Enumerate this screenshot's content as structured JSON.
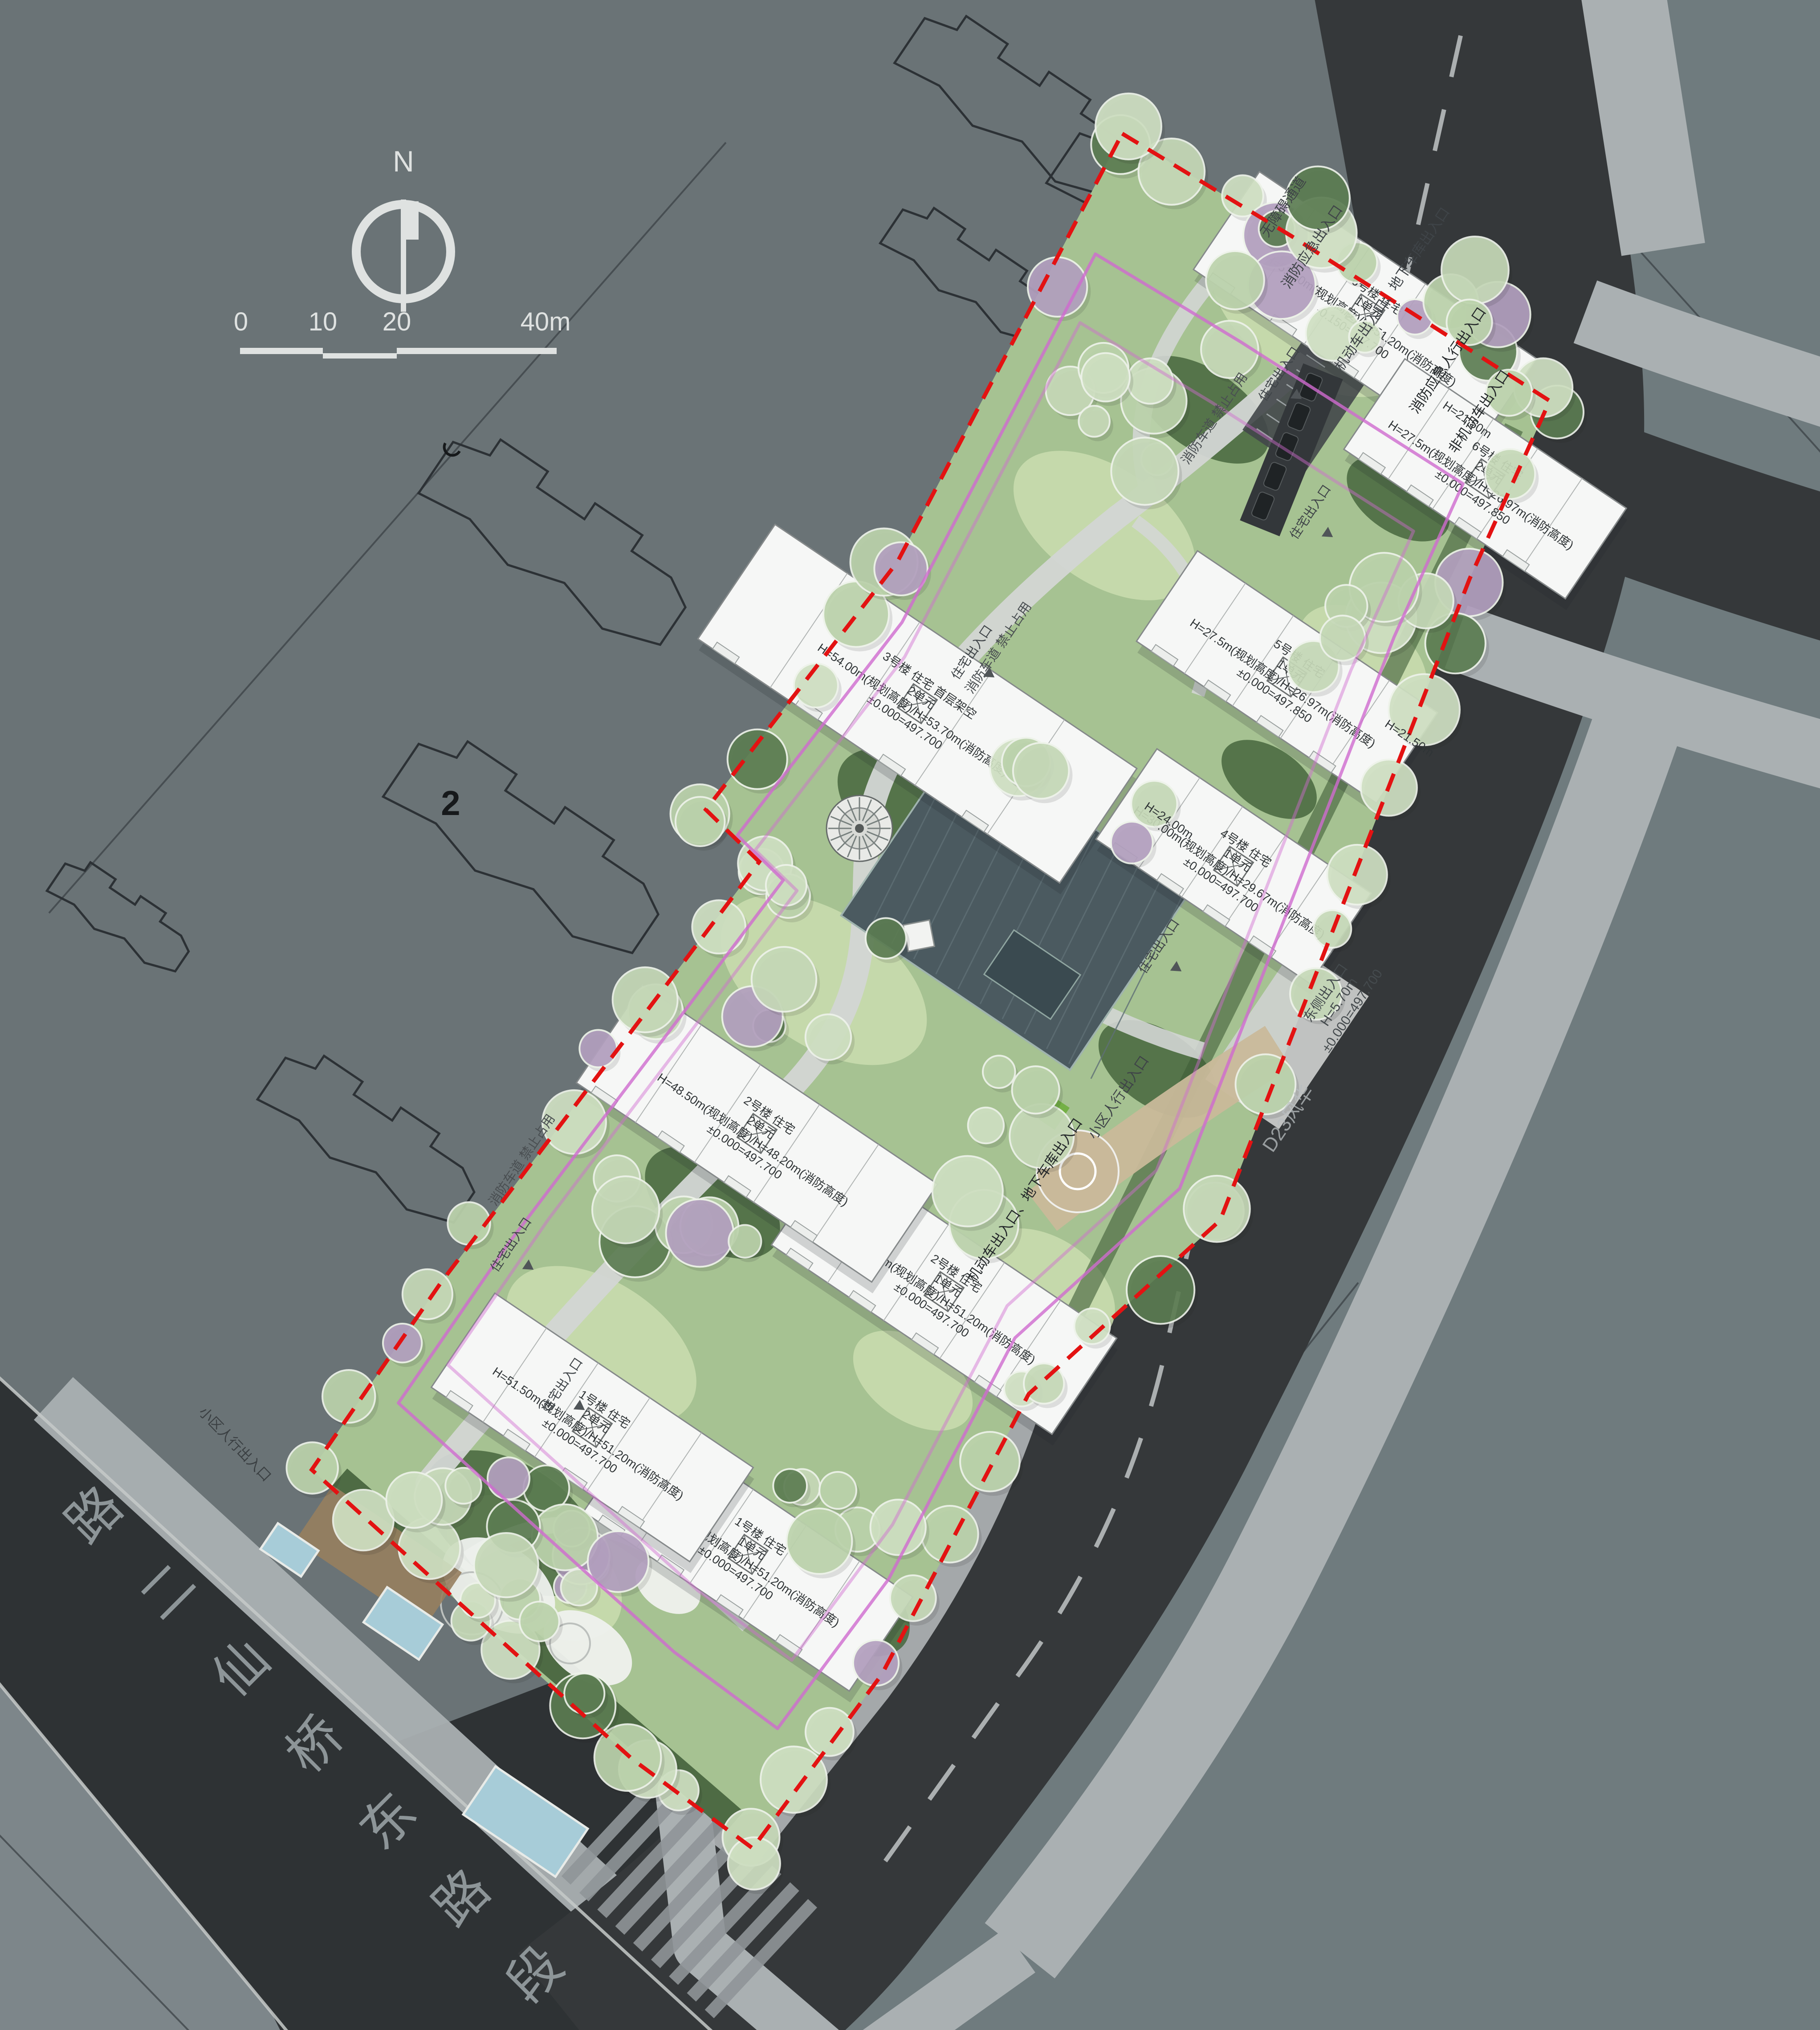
{
  "page": {
    "type": "architectural-site-plan"
  },
  "compass": {
    "label": "N"
  },
  "scale_bar": {
    "ticks": [
      "0",
      "10",
      "20",
      "40m"
    ]
  },
  "context": {
    "parcel_label": "2",
    "road_name_chars": [
      "路",
      "二",
      "仙",
      "桥",
      "东",
      "路",
      "段"
    ]
  },
  "labels": {
    "residential_entrance": "住宅出入口",
    "community_pedestrian_entrance": "小区人行出入口",
    "motor_entrance": "机动车出入口、地下车库出入口",
    "non_motor_entrance": "非机动车出入口",
    "fire_emergency_pedestrian_entrance": "消防应急人行出入口",
    "fire_emergency_entrance": "消防应急出入口",
    "barrier_free_passage": "无障碍通道",
    "fire_lane": "消防车道 禁止占用",
    "road_watermark": "D23风华",
    "h24": "H=24.00m",
    "h215": "H=21.50m",
    "east_entrance": {
      "line1": "东侧出入口",
      "line2": "H=5.70m",
      "line3": "±0.000=497.700"
    }
  },
  "buildings": [
    {
      "name": "1号楼 住宅",
      "unit": "1单元",
      "height": "H=51.50m(规划高度)/H=51.20m(消防高度)",
      "level": "±0.000=497.700"
    },
    {
      "name": "1号楼 住宅",
      "unit": "2单元",
      "height": "H=51.50m(规划高度)/H=51.20m(消防高度)",
      "level": "±0.000=497.700"
    },
    {
      "name": "2号楼 住宅",
      "unit": "1单元",
      "height": "H=51.50m(规划高度)/H=51.20m(消防高度)",
      "level": "±0.000=497.700"
    },
    {
      "name": "2号楼 住宅",
      "unit": "2单元",
      "height": "H=48.50m(规划高度)/H=48.20m(消防高度)",
      "level": "±0.000=497.700"
    },
    {
      "name": "3号楼 住宅 首层架空",
      "unit": "2单元",
      "height": "H=54.00m(规划高度)/H=53.70m(消防高度)",
      "level": "±0.000=497.700"
    },
    {
      "name": "4号楼 住宅",
      "unit": "1单元",
      "height": "H=30.00m(规划高度)/H=29.67m(消防高度)",
      "level": "±0.000=497.700"
    },
    {
      "name": "5号楼 住宅",
      "unit": "1单元",
      "height": "H=27.5m(规划高度)/H=26.97m(消防高度)",
      "level": "±0.000=497.850"
    },
    {
      "name": "6号楼 住宅",
      "unit": "1单元",
      "height": "H=51.50m(规划高度)/H=51.20m(消防高度)",
      "level": "-0.150=497.700"
    },
    {
      "name": "6号楼 住宅",
      "unit": "2单元",
      "height": "H=27.5m(规划高度)/H=26.97m(消防高度)",
      "level": "±0.000=497.850"
    }
  ],
  "colors": {
    "bg": "#6a7376",
    "bg_right": "#6f7b7e",
    "bg_bottom_left": "#7d868a",
    "road": "#35383a",
    "road_left": "#2e3234",
    "sidewalk": "#aab0b2",
    "site_green": "#a6c292",
    "lawn_light": "#c9dcae",
    "lawn_dark": "#47663d",
    "hedge": "#3f5d37",
    "tree": "#c3d6b4",
    "tree_purple": "#b3a0bf",
    "building": "#f6f7f6",
    "boundary_red": "#e31212",
    "fire_lane_line": "#d06ad0",
    "courtyard": "#4b5a60",
    "walk_path": "#d3d6d4",
    "deck": "#97805f",
    "pool": "#a7ccd8",
    "drive": "#c9b99a",
    "text_dark": "#2f3436",
    "text_road": "#24282a",
    "text_light": "#dfe2e1"
  }
}
